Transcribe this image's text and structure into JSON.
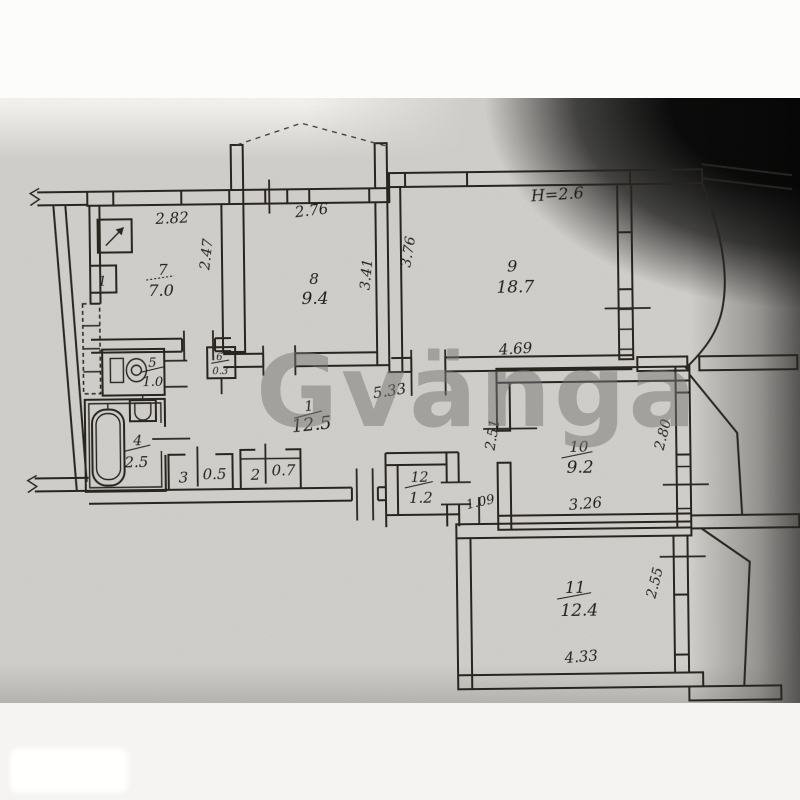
{
  "watermark": {
    "text": "Gvänga"
  },
  "colors": {
    "paper": "#d3d1cd",
    "ink": "#26231f",
    "vignette": "#000000",
    "watermark_gray": "#767674",
    "page_background": "#fcfcfb"
  },
  "scan": {
    "height_note": "H=2.6",
    "fixtures": {
      "cabinet_label": "1"
    },
    "rooms": [
      {
        "name": "hall",
        "number": "7",
        "area": "7.0",
        "label": "7/7.0"
      },
      {
        "name": "room-8",
        "number": "8",
        "area": "9.4",
        "label": "8/9.4"
      },
      {
        "name": "room-9",
        "number": "9",
        "area": "18.7",
        "label": "9/18.7"
      },
      {
        "name": "corridor",
        "number": "1",
        "area": "12.5",
        "label": "1/12.5"
      },
      {
        "name": "wc",
        "number": "5",
        "area": "1.0",
        "label": "5/1.0"
      },
      {
        "name": "niche",
        "number": "6",
        "area": "0.3",
        "label": "6/0.3"
      },
      {
        "name": "bathroom",
        "number": "4",
        "area": "2.5",
        "label": "4/2.5"
      },
      {
        "name": "closet-3",
        "number": "3",
        "area": "0.5",
        "label": "3/0.5"
      },
      {
        "name": "closet-2",
        "number": "2",
        "area": "0.7",
        "label": "2/0.7"
      },
      {
        "name": "pantry",
        "number": "12",
        "area": "1.2",
        "label": "12/1.2"
      },
      {
        "name": "room-10",
        "number": "10",
        "area": "9.2",
        "label": "10/9.2"
      },
      {
        "name": "room-11",
        "number": "11",
        "area": "12.4",
        "label": "11/12.4"
      }
    ],
    "dims": {
      "r7_w": "2.82",
      "r7_d": "2.47",
      "r8_w": "2.76",
      "r8_d": "3.41",
      "r9_d": "3.76",
      "r9_w": "4.69",
      "hall_w": "5.33",
      "r10_left": "2.51",
      "r10_right": "2.80",
      "r10_w": "3.26",
      "passage_w": "1.09",
      "r11_right": "2.55",
      "r11_w": "4.33"
    }
  }
}
